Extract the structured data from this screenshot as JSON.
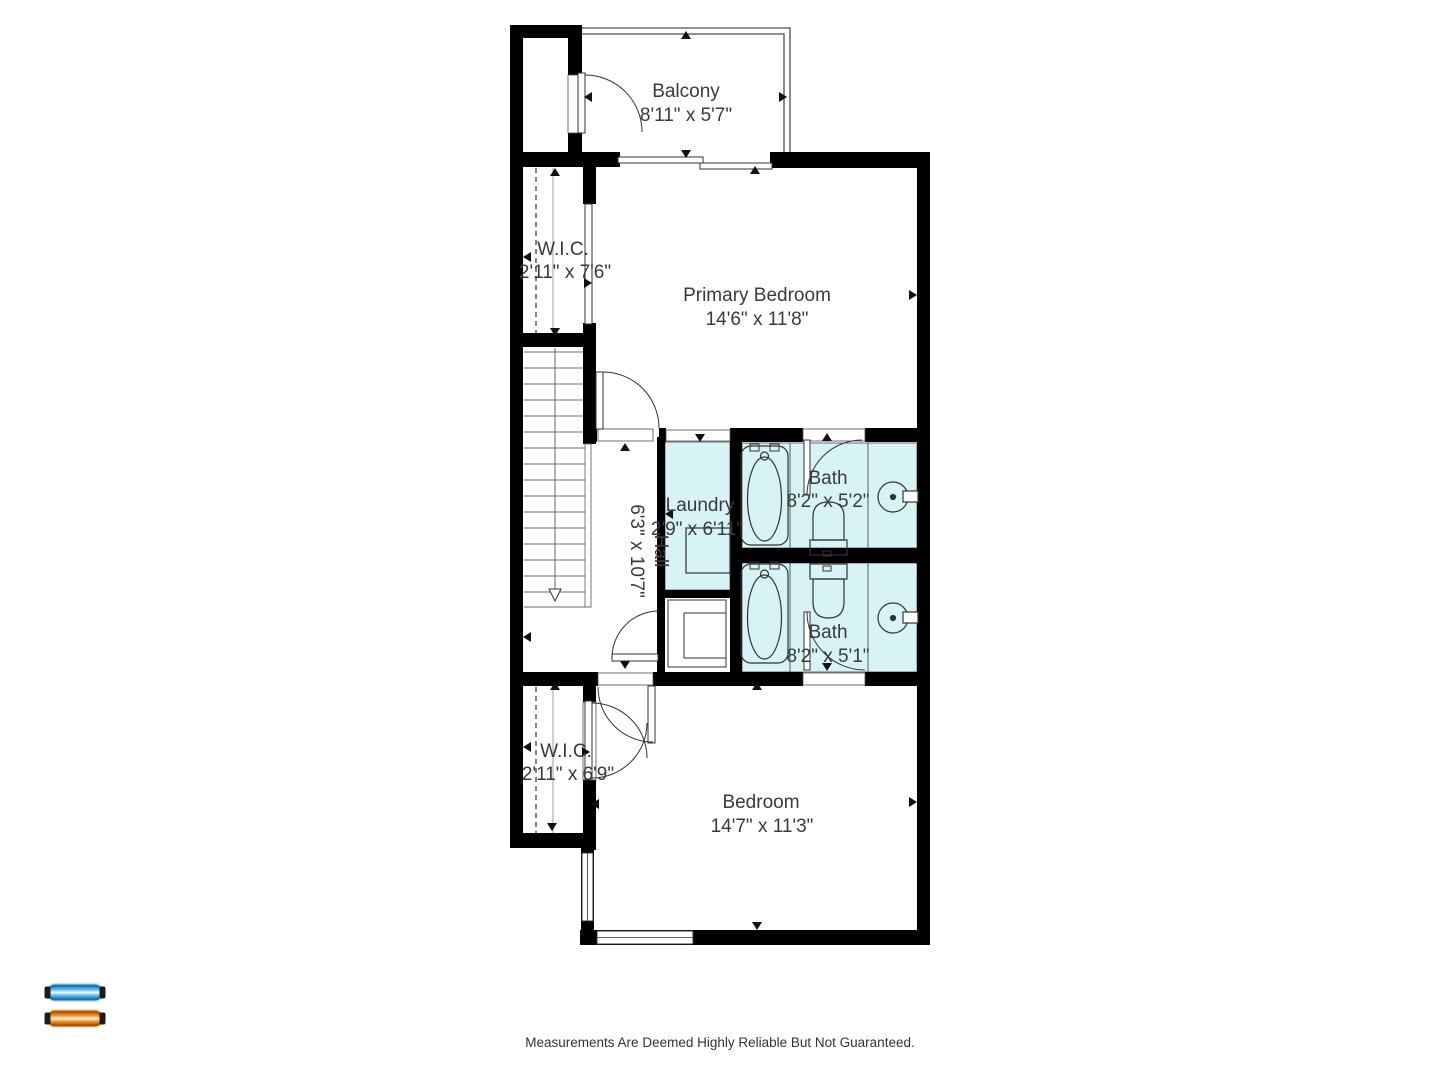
{
  "disclaimer": "Measurements Are Deemed Highly Reliable But Not Guaranteed.",
  "colors": {
    "wall": "#000000",
    "wet_fill": "#d7f3f6",
    "label": "#3a3a3a",
    "thin_line": "#4d4d4d",
    "logo_blue_outline": "#1a6fb5",
    "logo_blue_fill": "#5bb8ea",
    "logo_orange_outline": "#a85400",
    "logo_orange_fill": "#ef8d1e",
    "tube_cap": "#1c1c1c"
  },
  "rooms": {
    "balcony": {
      "name": "Balcony",
      "dims": "8'11\" x 5'7\""
    },
    "wic_top": {
      "name": "W.I.C.",
      "dims": "2'11\" x 7'6\""
    },
    "primary_bedroom": {
      "name": "Primary Bedroom",
      "dims": "14'6\" x 11'8\""
    },
    "laundry": {
      "name": "Laundry",
      "dims": "2'9\" x 6'11\""
    },
    "bath_top": {
      "name": "Bath",
      "dims": "8'2\" x 5'2\""
    },
    "hall": {
      "name": "Hall",
      "dims": "6'3\" x 10'7\""
    },
    "bath_bottom": {
      "name": "Bath",
      "dims": "8'2\" x 5'1\""
    },
    "wic_bottom": {
      "name": "W.I.C.",
      "dims": "2'11\" x 6'9\""
    },
    "bedroom": {
      "name": "Bedroom",
      "dims": "14'7\" x 11'3\""
    }
  }
}
